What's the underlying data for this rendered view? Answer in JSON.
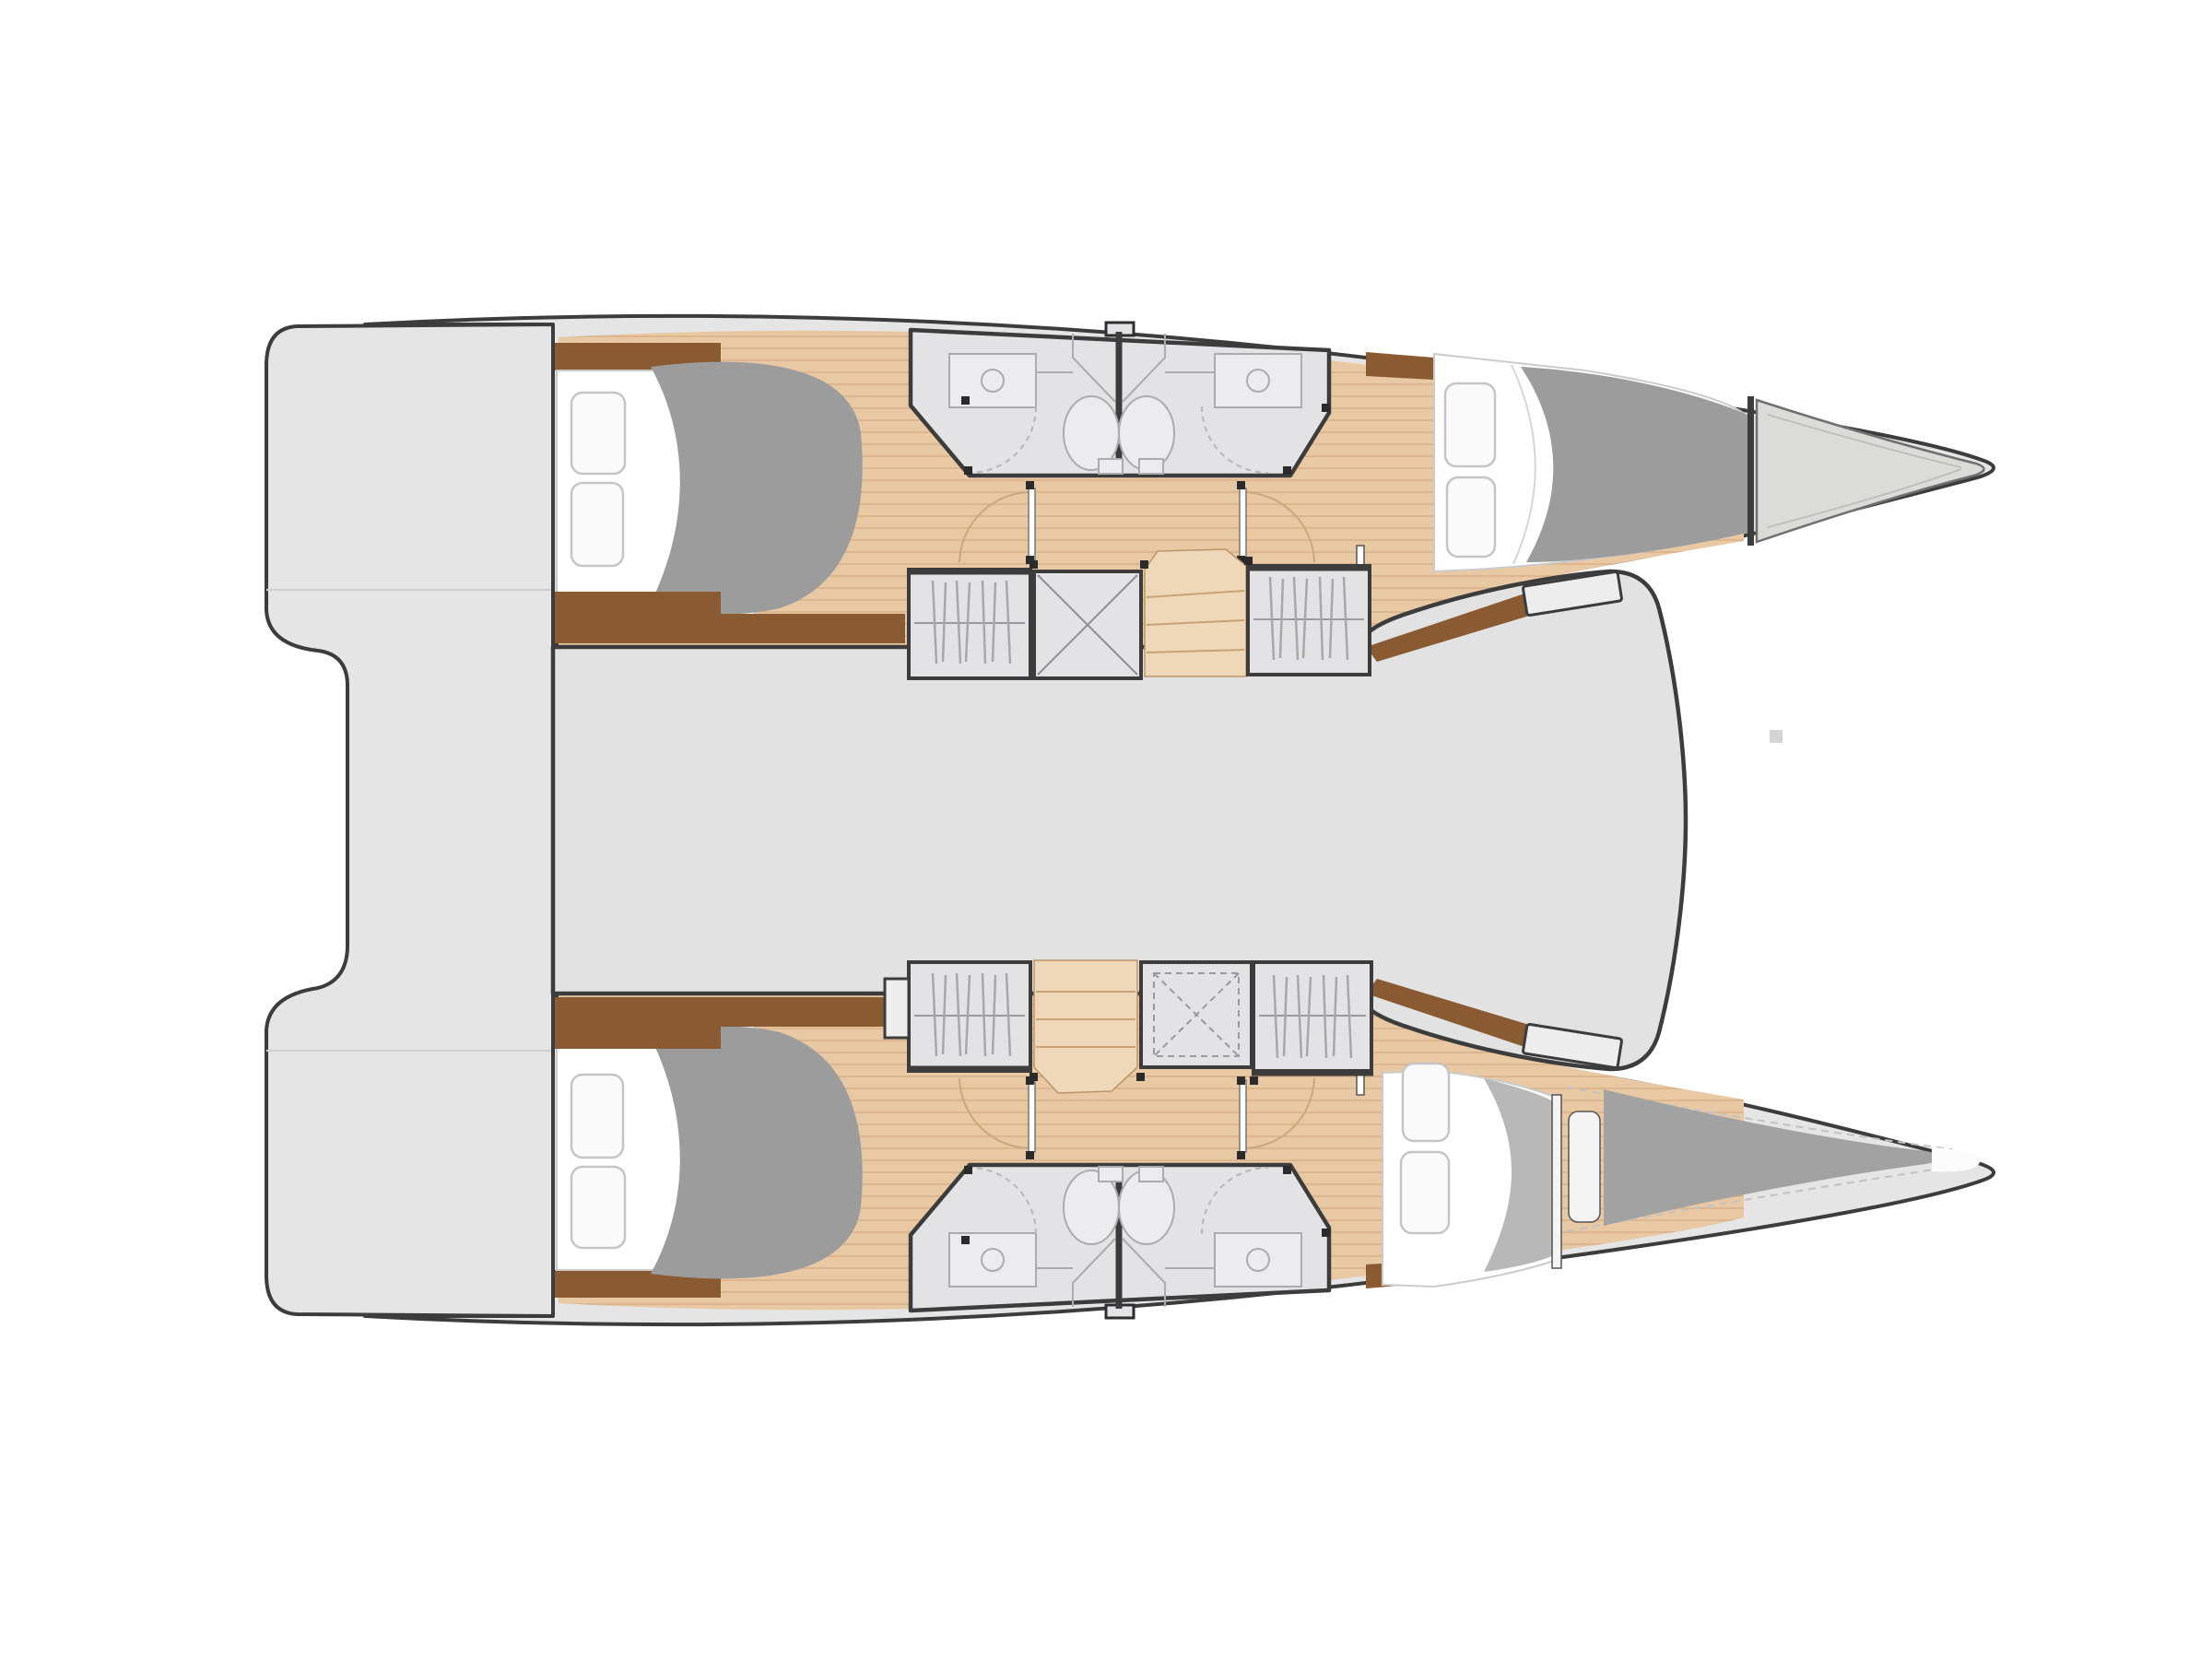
{
  "description": "Top-down interior layout floor plan of a sailing catamaran: twin hulls with pointed bows to the right, stern swim platform to the left, central saloon deck, four double cabins, four bathrooms with sinks and toilets, four hanging wardrobes, two companionway staircases and a forward trampoline area.",
  "layout_summary": {
    "hulls": 2,
    "double_cabins": 4,
    "bathrooms": 4,
    "hanging_wardrobes": 4,
    "storage_boxes": 2,
    "staircases": 2,
    "bow_lockers": 2
  },
  "colors": {
    "background": "#ffffff",
    "deck": "#e5e5e5",
    "saloon": "#e2e2e2",
    "outline": "#3c3c3c",
    "wood": "#e8c9a4",
    "woodLine": "#d9b288",
    "stairs": "#efd7ba",
    "brown": "#8a5a33",
    "duvet": "#9c9c9c",
    "duvet2": "#b8b8b8",
    "mattress": "#ffffff",
    "bath": "#e3e3e5",
    "bathFixFill": "#ececee",
    "fixture": "#ababb0",
    "bowLight": "#dbdbd9",
    "bowDark": "#a2a2a2"
  }
}
